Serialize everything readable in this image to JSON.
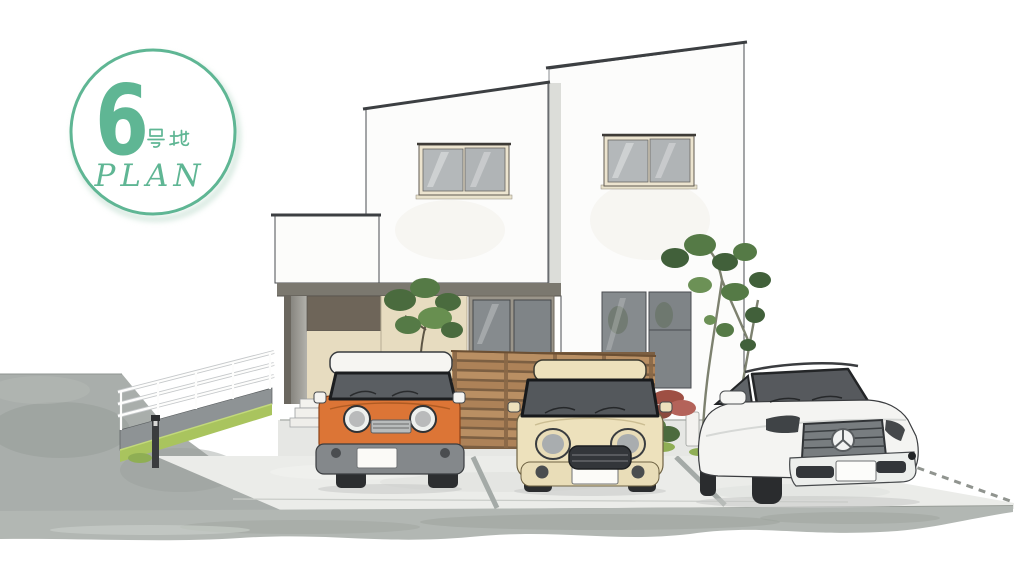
{
  "badge": {
    "number": "6",
    "suffix": "号地",
    "label": "PLAN",
    "accent_color": "#5fb694"
  },
  "scene": {
    "palette": {
      "house_white": "#fcfcfb",
      "soffit_dark": "#7b786f",
      "accent_panel_brown": "#6e6559",
      "entry_beige": "#e7dcc0",
      "window_glass": "#b4b8ba",
      "fence_wood": "#b98f63",
      "car_orange": "#dc7536",
      "car_cream": "#ede1bc",
      "car_white": "#f4f4f2",
      "grass_green": "#a9c45e",
      "tree_green": "#4a6b3e",
      "road_gray": "#a9aeab",
      "driveway_gray": "#ebece9",
      "curb_gray": "#b2b7b3"
    }
  }
}
